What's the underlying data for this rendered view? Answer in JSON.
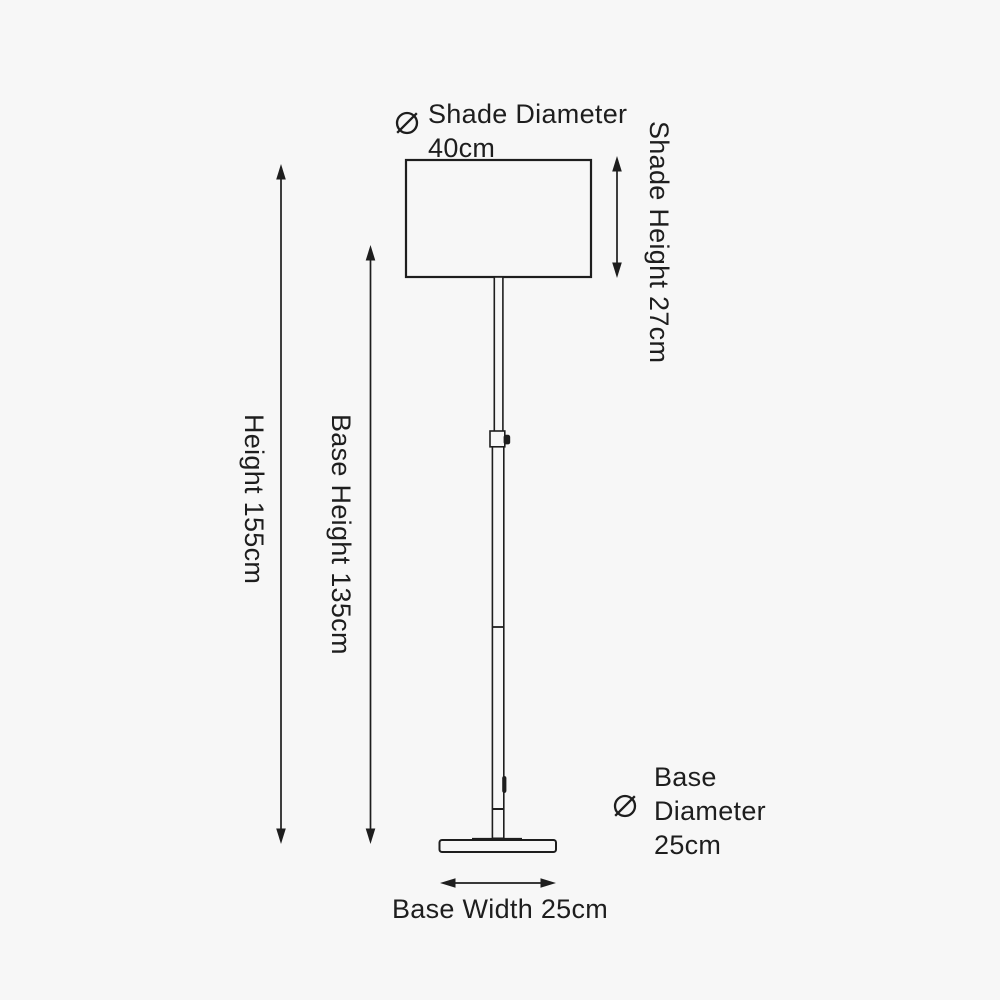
{
  "colors": {
    "background": "#f7f7f7",
    "ink": "#1e1e1e"
  },
  "icons": {
    "diameter_symbol": "⌀"
  },
  "labels": {
    "shade_diameter": {
      "name": "Shade Diameter",
      "value": "40cm"
    },
    "shade_height": "Shade Height 27cm",
    "overall_height": "Height 155cm",
    "base_height": "Base Height 135cm",
    "base_diameter": {
      "line1": "Base",
      "line2": "Diameter",
      "line3": "25cm"
    },
    "base_width": "Base Width 25cm"
  },
  "measurements": [
    {
      "part": "Shade Diameter",
      "value_cm": 40
    },
    {
      "part": "Shade Height",
      "value_cm": 27
    },
    {
      "part": "Height",
      "value_cm": 155
    },
    {
      "part": "Base Height",
      "value_cm": 135
    },
    {
      "part": "Base Diameter",
      "value_cm": 25
    },
    {
      "part": "Base Width",
      "value_cm": 25
    }
  ]
}
